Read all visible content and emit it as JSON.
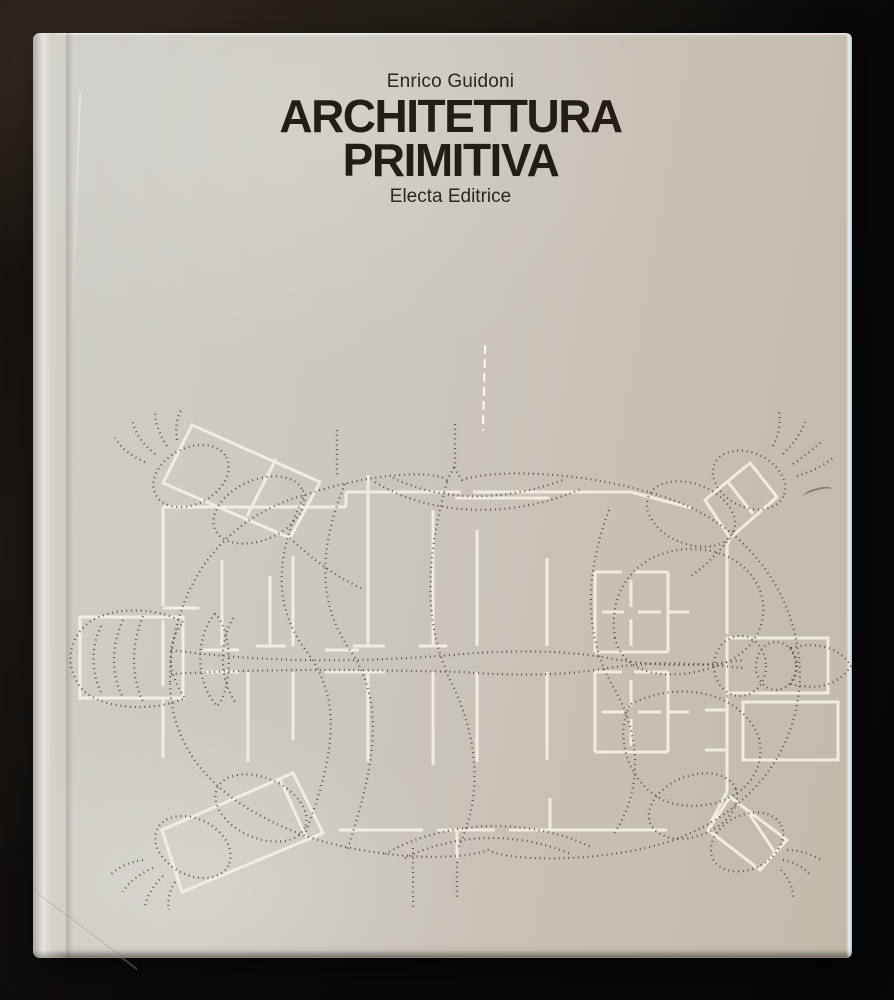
{
  "scene": {
    "type": "photograph",
    "description": "Hardcover book with a silver-grey dust jacket lying on a dark surface",
    "background_color": "#12100d"
  },
  "book": {
    "author": "Enrico Guidoni",
    "title_line_1": "ARCHITETTURA",
    "title_line_2": "PRIMITIVA",
    "publisher": "Electa Editrice",
    "cover_color": "#cbc7be",
    "text_color": "#221d17",
    "illustration": {
      "name": "turtle-floor-plan-drawing",
      "description": "Top view of a turtle drawn in dotted dark lines overlaid with a primitive settlement floor plan drawn in solid cream-white lines",
      "dotted_line_color": "#49423a",
      "plan_line_color": "#f3efe2"
    }
  }
}
